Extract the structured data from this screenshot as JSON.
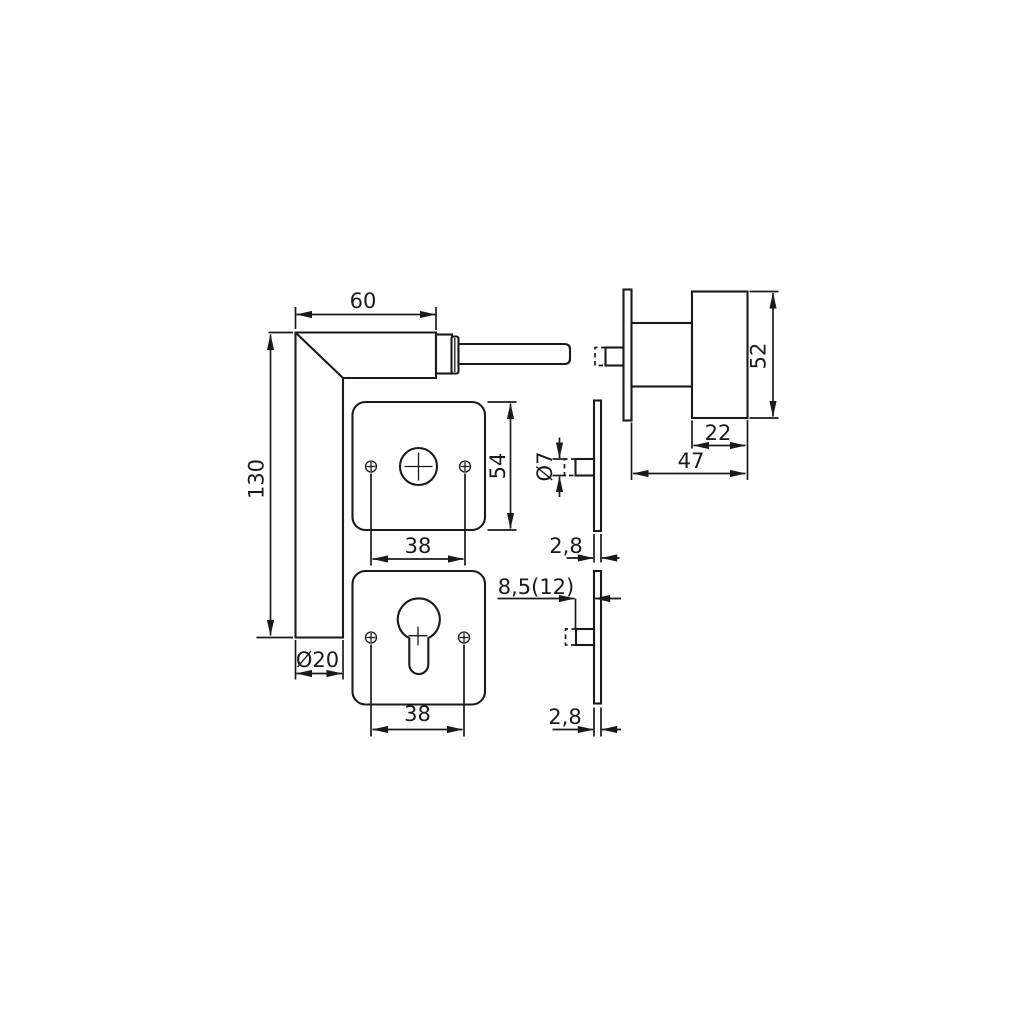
{
  "app": {
    "background": "#ffffff",
    "line_color": "#1a1a1a"
  },
  "dimensions": {
    "lever_head_width": "60",
    "lever_total_length": "130",
    "grip_diameter": "Ø20",
    "lever_rosette_size": "54",
    "lever_rosette_screw_spacing": "38",
    "cylinder_rosette_screw_spacing": "38",
    "spindle_diameter": "Ø7",
    "lever_rosette_thickness": "2,8",
    "cylinder_rosette_thickness": "2,8",
    "cylinder_projection": "8,5(12)",
    "knob_diameter": "52",
    "knob_head_depth": "22",
    "knob_total_projection": "47"
  }
}
